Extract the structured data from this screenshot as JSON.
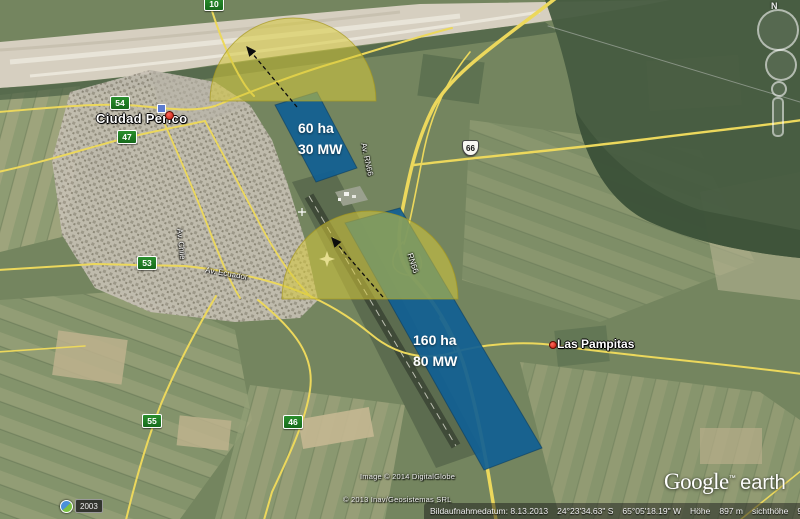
{
  "map": {
    "city_label": "Ciudad Perico",
    "town_label": "Las Pampitas",
    "route_badges": [
      {
        "label": "10"
      },
      {
        "label": "54"
      },
      {
        "label": "47"
      },
      {
        "label": "53"
      },
      {
        "label": "55"
      },
      {
        "label": "46"
      }
    ],
    "route_shield": {
      "label": "66"
    },
    "street_labels": [
      {
        "label": "Av. RN66"
      },
      {
        "label": "RN66"
      },
      {
        "label": "Av. Ecuador"
      },
      {
        "label": "Av. Chile"
      }
    ]
  },
  "overlays": {
    "site_north": {
      "area": "60 ha",
      "power": "30 MW"
    },
    "site_south": {
      "area": "160 ha",
      "power": "80 MW"
    }
  },
  "controls": {
    "compass_north": "N",
    "time_label": "2003"
  },
  "status_bar": {
    "imagery_date": "Bildaufnahmedatum: 8.13.2013",
    "latitude": "24°23'34.63\" S",
    "longitude": "65°05'18.19\" W",
    "elevation_label": "Höhe",
    "elevation_value": "897 m",
    "eye_altitude_label": "sichthöhe",
    "eye_altitude_value": "9.94 km"
  },
  "branding": {
    "google": "Google",
    "tm": "™",
    "earth": "earth",
    "copyright_imagery": "Image © 2014 DigitalGlobe",
    "copyright_gis": "© 2013 Inav/Geosistemas SRL"
  },
  "colors": {
    "overlay_blue": "#105f94",
    "overlay_yellow": "#d6c93a",
    "road_yellow": "#ecd85c",
    "badge_green": "#1e7a1e"
  }
}
